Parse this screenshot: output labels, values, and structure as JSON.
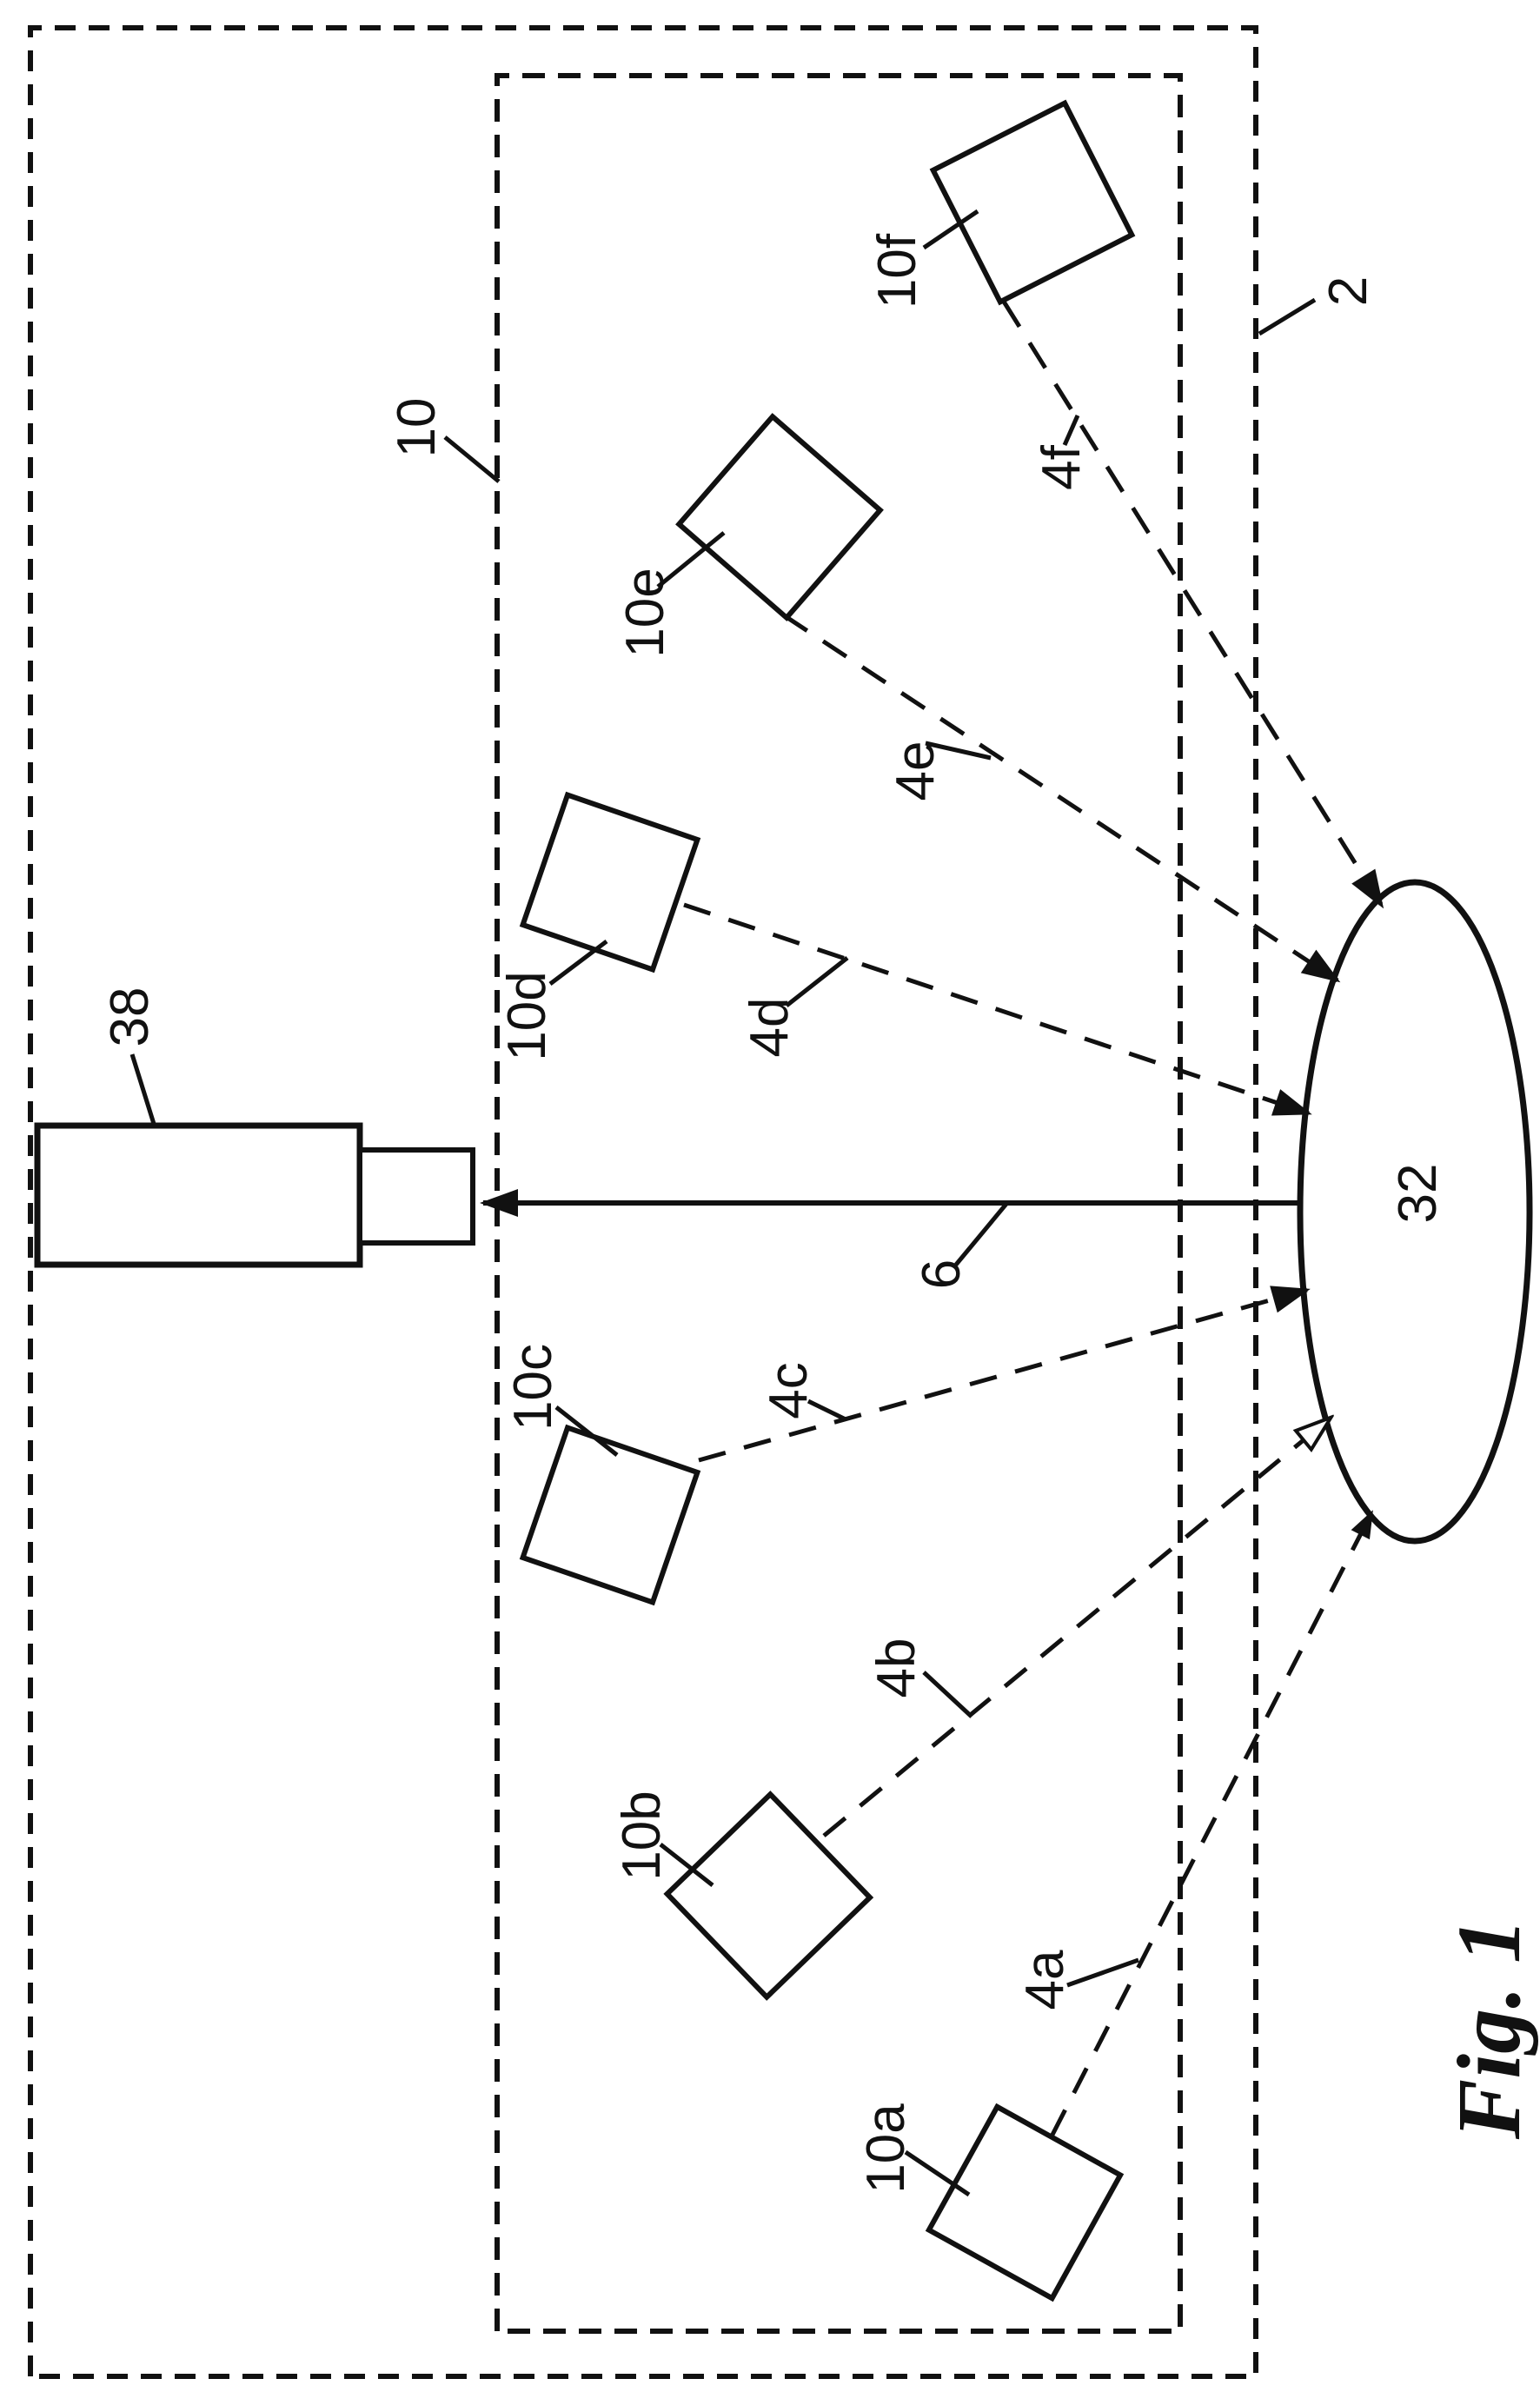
{
  "figure": {
    "caption": "Fig. 1",
    "ink_color": "#111111",
    "background_color": "#ffffff",
    "outer_boundary_label": "2",
    "inner_boundary_label": "10",
    "ellipse_label": "32",
    "device_label": "38",
    "link_label": "6",
    "nodes": [
      {
        "label": "10a"
      },
      {
        "label": "10b"
      },
      {
        "label": "10c"
      },
      {
        "label": "10d"
      },
      {
        "label": "10e"
      },
      {
        "label": "10f"
      }
    ],
    "arrows": [
      {
        "label": "4a"
      },
      {
        "label": "4b"
      },
      {
        "label": "4c"
      },
      {
        "label": "4d"
      },
      {
        "label": "4e"
      },
      {
        "label": "4f"
      }
    ]
  }
}
